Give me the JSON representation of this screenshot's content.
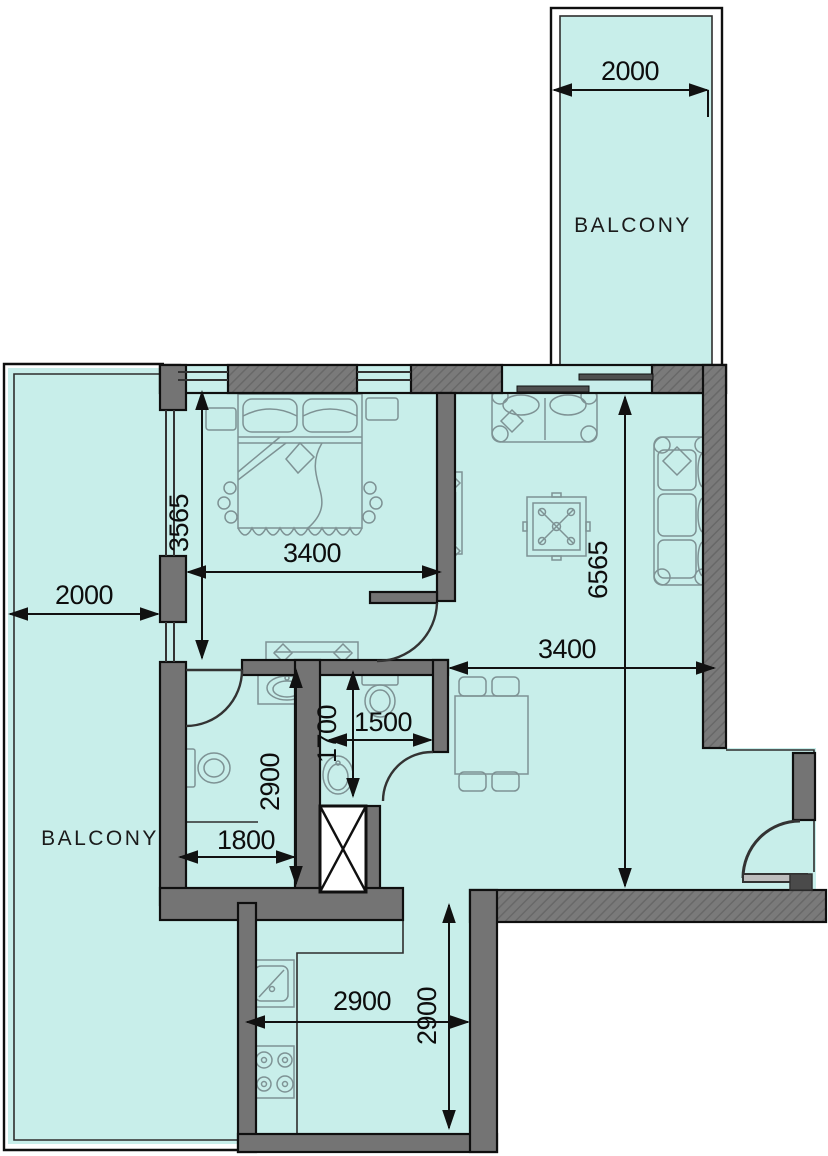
{
  "plan": {
    "type": "apartment-floor-plan",
    "colors": {
      "floor": "#c8eeea",
      "wall": "#747474",
      "wall_hatch": "#636363",
      "outline": "#0f0f0f",
      "furniture": "#7e9294",
      "dim_text": "#0d0d0d",
      "shaft_fill": "#ffffff"
    },
    "labels": {
      "balcony_top": "BALCONY",
      "balcony_left": "BALCONY"
    },
    "dimensions": {
      "balcony_top_width": "2000",
      "balcony_left_width": "2000",
      "bedroom_depth": "3565",
      "bedroom_width": "3400",
      "living_depth": "6565",
      "living_width": "3400",
      "bath_depth": "2900",
      "bath_width": "1800",
      "wc_depth": "1700",
      "wc_width": "1500",
      "kitchen_width": "2900",
      "kitchen_depth": "2900"
    }
  }
}
